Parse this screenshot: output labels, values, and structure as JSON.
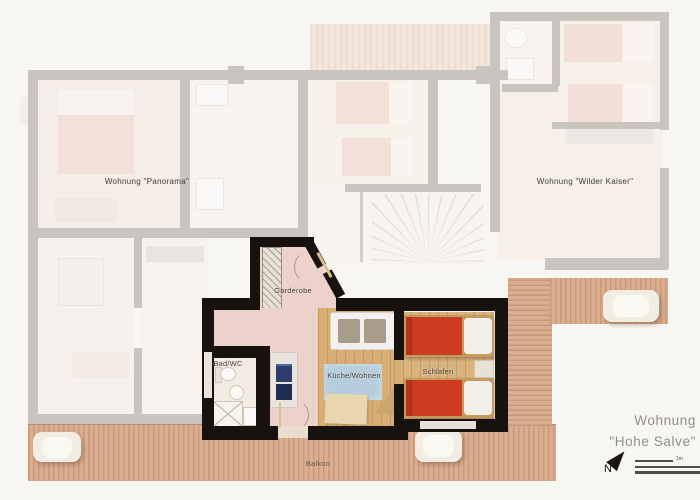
{
  "labels": {
    "panorama": "Wohnung \"Panorama\"",
    "wilder_kaiser": "Wohnung \"Wilder Kaiser\"",
    "hohe_salve_line1": "Wohnung",
    "hohe_salve_line2": "\"Hohe Salve\"",
    "garderobe": "Garderobe",
    "bad_wc": "Bad/WC",
    "kueche_wohnen": "Küche/Wohnen",
    "schlafen": "Schlafen",
    "balkon": "Balkon",
    "north": "N",
    "scale_1m": "1m"
  },
  "colors": {
    "background": "#f8f6f3",
    "highlight_wall": "#17120e",
    "faded_wall": "#8f8b86",
    "wood_floor": "#d8ae74",
    "deck_wood": "#dcae8f",
    "bed_red": "#cd3c20",
    "rug_blue": "#b5cddc",
    "hall_pink": "#ecd2cb",
    "appliance_navy": "#2e3d6b",
    "muted_label": "#908d8a"
  }
}
